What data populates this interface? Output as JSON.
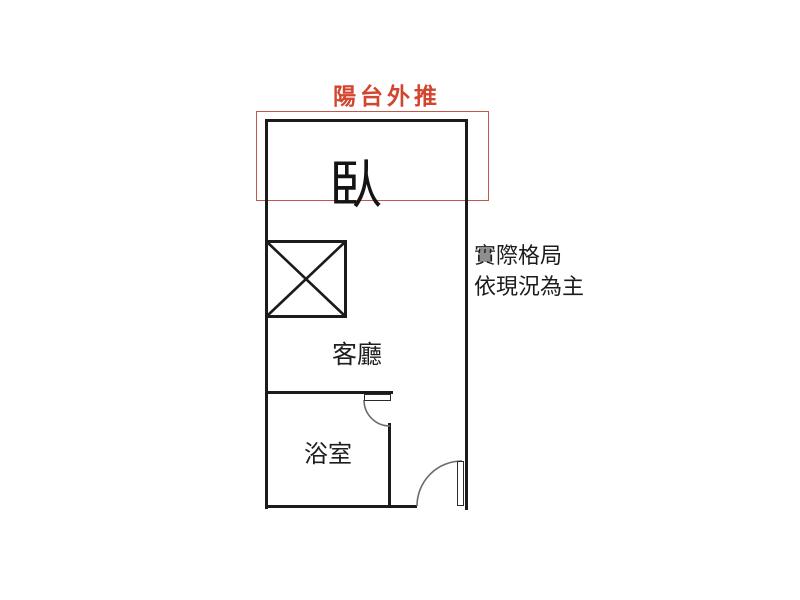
{
  "plan": {
    "balcony": {
      "label": "陽台外推"
    },
    "rooms": {
      "bedroom": "臥",
      "living": "客廳",
      "bathroom": "浴室"
    },
    "note": {
      "line1": "實際格局",
      "line2": "依現況為主"
    },
    "colors": {
      "accent_red_text": "#d2452f",
      "balcony_outline_red": "#c4564a",
      "wall_black": "#1b1b1b",
      "door_arc_gray": "#6b6b6b"
    }
  }
}
